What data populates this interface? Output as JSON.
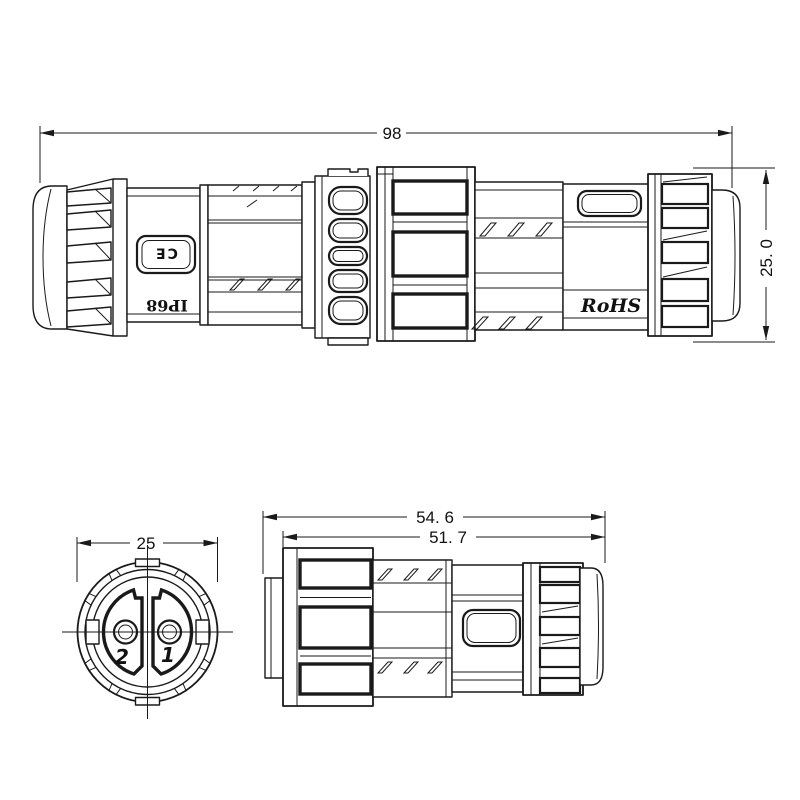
{
  "drawing": {
    "background": "#ffffff",
    "line_color": "#1a1a1a"
  },
  "dimensions": {
    "overall_length": "98",
    "overall_diameter": "25. 0",
    "face_diameter": "25",
    "plug_total_length": "54. 6",
    "plug_body_length": "51. 7"
  },
  "markings": {
    "ce_mark": "CE",
    "ip_rating": "IP68",
    "rohs": "RoHS"
  },
  "pin_labels": {
    "pin2": "2",
    "pin1": "1"
  }
}
